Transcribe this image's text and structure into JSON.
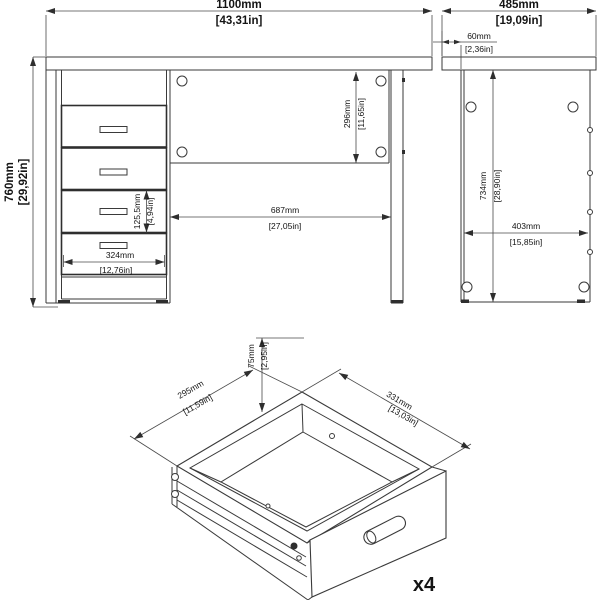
{
  "drawing": {
    "type": "furniture assembly dimension drawing",
    "product": "desk with pedestal drawers",
    "front_view": {
      "overall_width": {
        "mm": "1100mm",
        "in": "[43,31in]"
      },
      "overall_height": {
        "mm": "760mm",
        "in": "[29,92in]"
      },
      "back_panel_height": {
        "mm": "296mm",
        "in": "[11,65in]"
      },
      "knee_space_width": {
        "mm": "687mm",
        "in": "[27,05in]"
      },
      "drawer_front_height": {
        "mm": "125,5mm",
        "in": "[4,94in]"
      },
      "drawer_front_width": {
        "mm": "324mm",
        "in": "[12,76in]"
      }
    },
    "side_view": {
      "overall_depth": {
        "mm": "485mm",
        "in": "[19,09in]"
      },
      "top_setback": {
        "mm": "60mm",
        "in": "[2,36in]"
      },
      "side_panel_height": {
        "mm": "734mm",
        "in": "[28,90in]"
      },
      "side_panel_depth": {
        "mm": "403mm",
        "in": "[15,85in]"
      }
    },
    "drawer_view": {
      "inner_height": {
        "mm": "75mm",
        "in": "[2,95in]"
      },
      "inner_depth": {
        "mm": "295mm",
        "in": "[11,59in]"
      },
      "inner_width": {
        "mm": "331mm",
        "in": "[13,03in]"
      },
      "quantity": "x4"
    }
  }
}
